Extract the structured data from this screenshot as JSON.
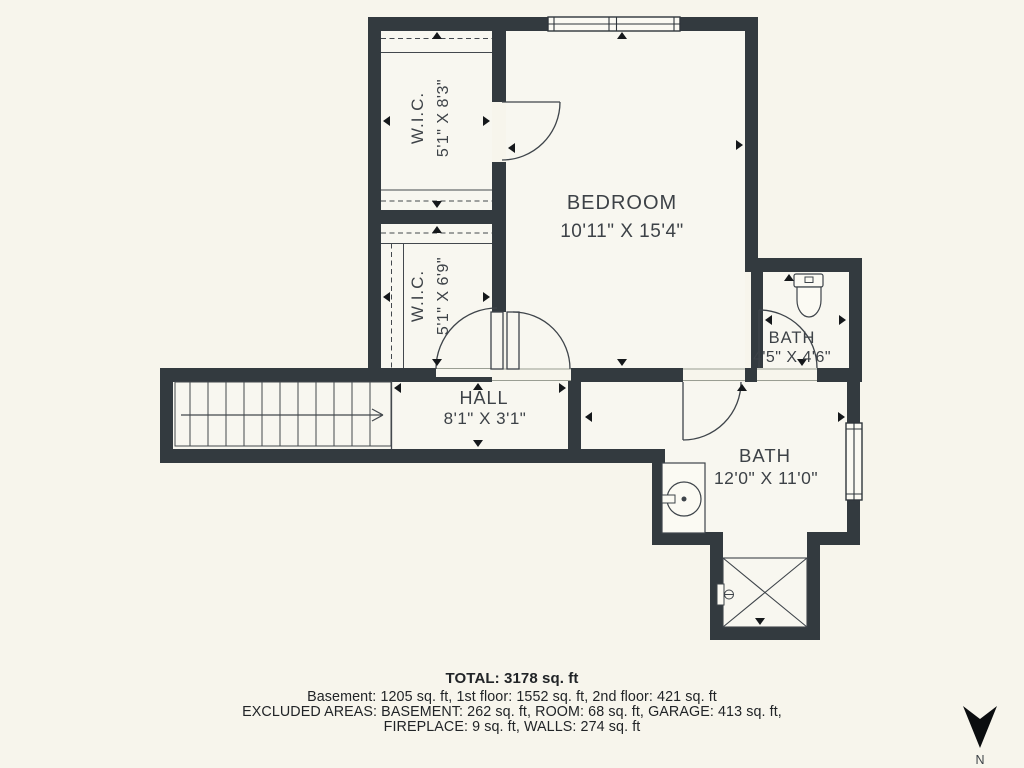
{
  "plan": {
    "rooms": {
      "wic_top": {
        "label": "W.I.C.",
        "dims": "5'1\" X 8'3\""
      },
      "wic_mid": {
        "label": "W.I.C.",
        "dims": "5'1\" X 6'9\""
      },
      "bedroom": {
        "label": "BEDROOM",
        "dims": "10'11\" X 15'4\""
      },
      "bath_small": {
        "label": "BATH",
        "dims": "4'5\" X 4'6\""
      },
      "hall": {
        "label": "HALL",
        "dims": "8'1\" X 3'1\""
      },
      "bath_large": {
        "label": "BATH",
        "dims": "12'0\" X 11'0\""
      }
    },
    "compass": {
      "label": "N"
    }
  },
  "summary": {
    "total": "TOTAL: 3178 sq. ft",
    "floors": "Basement: 1205 sq. ft, 1st floor: 1552 sq. ft, 2nd floor: 421 sq. ft",
    "excluded_1": "EXCLUDED AREAS: BASEMENT: 262 sq. ft, ROOM: 68 sq. ft, GARAGE: 413 sq. ft,",
    "excluded_2": "FIREPLACE: 9 sq. ft, WALLS: 274 sq. ft"
  },
  "colors": {
    "background": "#f7f5ec",
    "floor": "#f8f7f0",
    "wall": "#333a3f",
    "line": "#3e444a",
    "text": "#3d4247",
    "footer_text": "#212427"
  }
}
